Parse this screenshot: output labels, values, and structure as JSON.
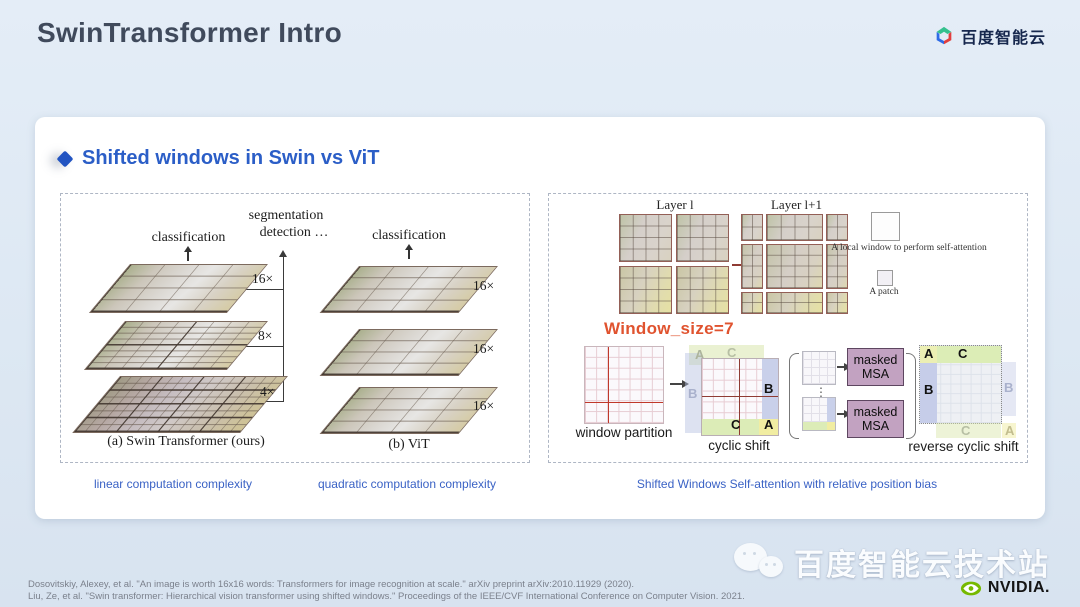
{
  "page": {
    "title": "SwinTransformer Intro",
    "brand": "百度智能云",
    "heading": "Shifted windows in Swin vs ViT"
  },
  "fig_compare": {
    "swin": {
      "classification": "classification",
      "segmentation": "segmentation",
      "detection": "detection …",
      "scale_16": "16×",
      "scale_8": "8×",
      "scale_4": "4×",
      "caption": "(a) Swin Transformer (ours)",
      "note": "linear computation complexity"
    },
    "vit": {
      "classification": "classification",
      "scale_16": "16×",
      "caption": "(b) ViT",
      "note": "quadratic computation complexity"
    }
  },
  "fig_shift": {
    "layer_l": "Layer l",
    "layer_l1": "Layer l+1",
    "legend_window": "A local window to perform self-attention",
    "legend_patch": "A patch",
    "window_size": "Window_size=7",
    "window_partition": "window partition",
    "cyclic_shift": "cyclic shift",
    "reverse_cyclic_shift": "reverse cyclic shift",
    "masked": "masked",
    "msa": "MSA",
    "ellipsis": "⋮",
    "A": "A",
    "B": "B",
    "C": "C",
    "note": "Shifted Windows Self-attention with relative position bias"
  },
  "footer": {
    "citation_1": "Dosovitskiy, Alexey, et al. \"An image is worth 16x16 words: Transformers for image recognition at scale.\" arXiv preprint arXiv:2010.11929 (2020).",
    "citation_2": "Liu, Ze, et al. \"Swin transformer: Hierarchical vision transformer using shifted windows.\" Proceedings of the IEEE/CVF International Conference on Computer Vision. 2021."
  },
  "watermark": {
    "text": "百度智能云技术站",
    "nvidia": "NVIDIA."
  },
  "colors": {
    "accent_blue": "#2b5ec7",
    "window_size_red": "#e0532f",
    "msa_fill": "#c2a2c1",
    "region_blue": "#c9d0ea",
    "region_green": "#dcecb7",
    "region_yellow": "#f1eda2"
  }
}
